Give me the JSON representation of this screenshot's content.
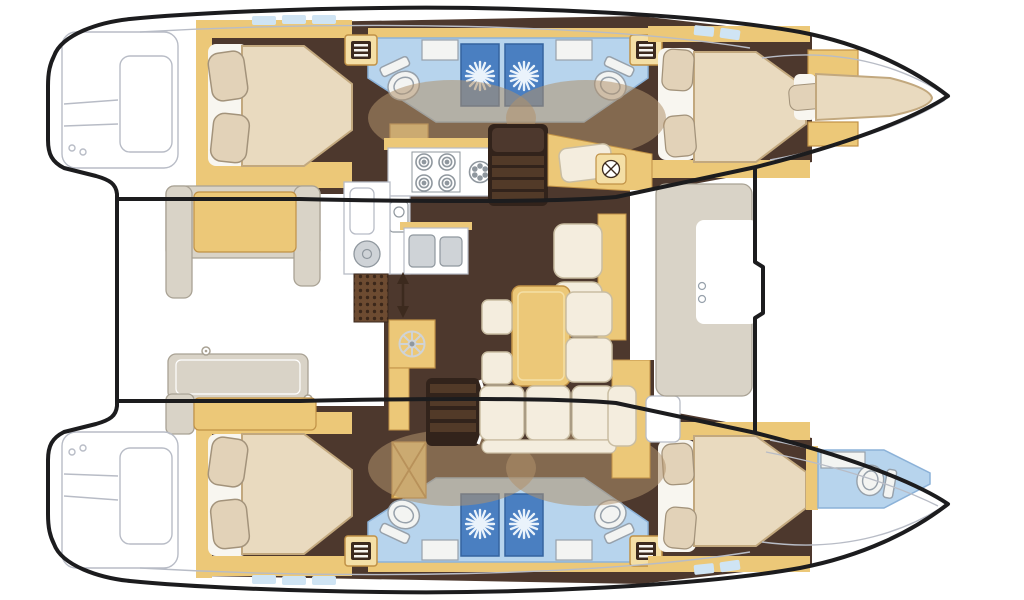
{
  "figure": {
    "type": "floor-plan",
    "subject": "catamaran-yacht-interior",
    "view": "top-down"
  },
  "visible_features": {
    "double_cabins": 4,
    "bow_berths": 1,
    "bathrooms": 5,
    "shower_stalls": 4,
    "toilets": 5,
    "bathroom_sinks": 5,
    "galley_sinks": 2,
    "stove_burners": 4,
    "companionway_stairs": 2,
    "hull_entry_steps": 4,
    "helm_wheel": 1,
    "cockpit_benches": 2,
    "cockpit_table": 1,
    "dinette_table": 1
  },
  "icons": {
    "shower_drain": "sunburst",
    "toilet": "bowl-with-tank",
    "hull_steps": "ladder-bars",
    "helm": "spoked-wheel",
    "lift_ring": "small-ring",
    "passage": "double-arrow-vertical"
  },
  "colors": {
    "outline": "#1c1c1e",
    "deck": "#ffffff",
    "deck_line": "#b8bcc6",
    "wood": "#ecc878",
    "wood_light": "#f4dfa6",
    "wood_dark": "#c09146",
    "floor": "#4d382d",
    "floor_dark": "#32231b",
    "overlay": "#b0916c",
    "bed": "#e9dabf",
    "bed_edge": "#c2a87e",
    "sheet": "#f8f6f0",
    "pillow": "#e2d2b8",
    "pillow_edge": "#a3937b",
    "bath": "#b7d4ed",
    "bath_edge": "#8cb2d8",
    "shower": "#4a7fc1",
    "shower_edge": "#34639f",
    "star": "#eaf3fb",
    "porcelain": "#f3f4f2",
    "porcelain_edge": "#97a1ab",
    "greige": "#d9d3c7",
    "greige_edge": "#a9a294",
    "cream": "#f4edde",
    "cream_edge": "#c9bda2",
    "window": "#cfe4f4",
    "grate": "#6d4b31",
    "grate_dot": "#3b271a",
    "steps": "#523a28",
    "icon_dark": "#3c2a1e",
    "metal": "#cfd3d7",
    "metal_edge": "#8f979e",
    "white": "#ffffff"
  }
}
